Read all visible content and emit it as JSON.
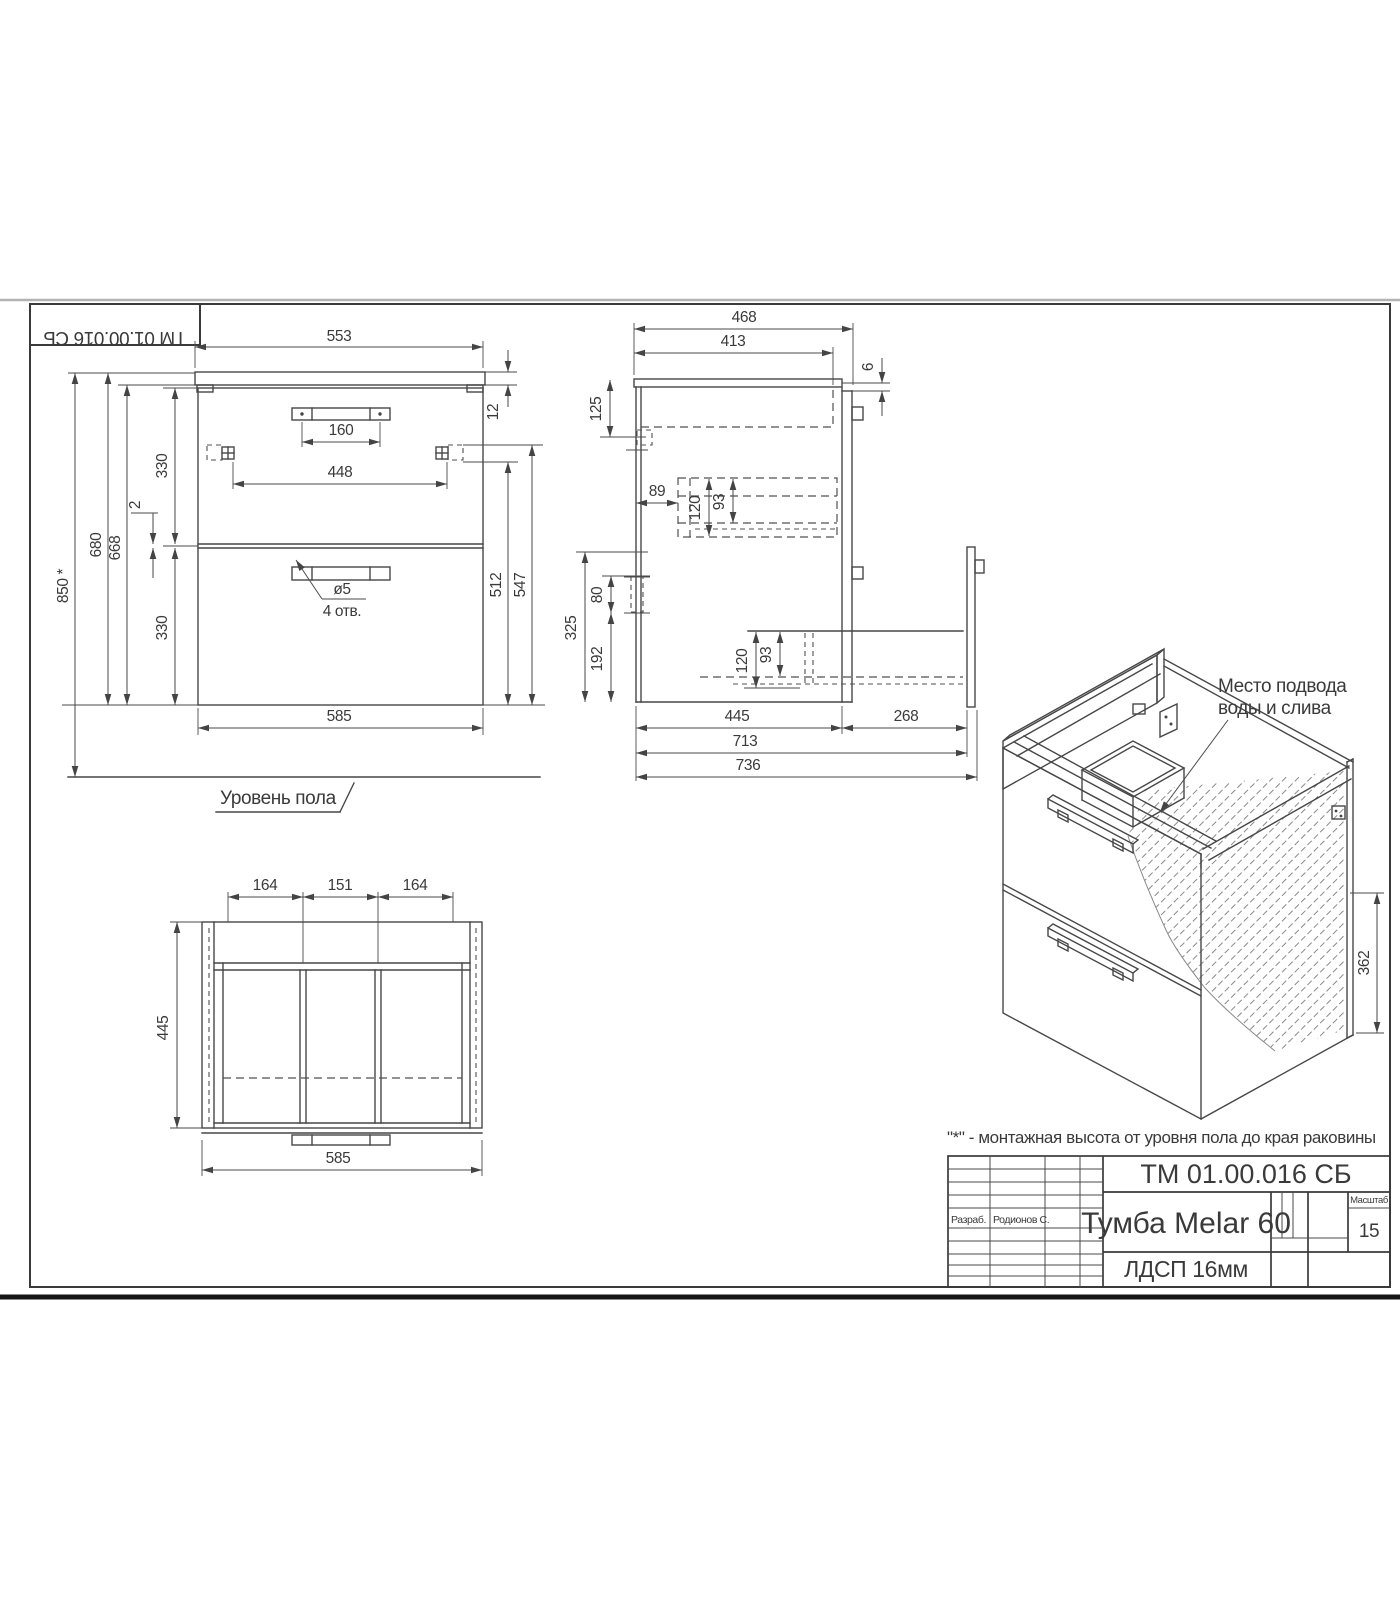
{
  "corner_stamp": {
    "text": "ТМ 01.00.016 СБ"
  },
  "front_view": {
    "floor_label": "Уровень пола",
    "hole_dia": "ø5",
    "hole_qty": "4 отв.",
    "dims": {
      "w553": "553",
      "w160": "160",
      "w448": "448",
      "t12": "12",
      "h330_top": "330",
      "gap2": "2",
      "h680": "680",
      "h668": "668",
      "h850": "850 *",
      "h330_bottom": "330",
      "h512": "512",
      "h547": "547",
      "w585": "585"
    }
  },
  "side_view": {
    "dims": {
      "d468": "468",
      "d413": "413",
      "g6": "6",
      "h125": "125",
      "d89": "89",
      "h120_top": "120",
      "h93_top": "93",
      "h80": "80",
      "h325": "325",
      "h192": "192",
      "h120_bottom": "120",
      "h93_bottom": "93",
      "d445": "445",
      "d268": "268",
      "d713": "713",
      "d736": "736"
    }
  },
  "top_view": {
    "dims": {
      "w164_left": "164",
      "w151": "151",
      "w164_right": "164",
      "d445": "445",
      "w585": "585"
    }
  },
  "iso_view": {
    "callout_line1": "Место подвода",
    "callout_line2": "воды и слива",
    "dim_362": "362"
  },
  "note": {
    "text": "\"*\" - монтажная высота от уровня пола до края раковины"
  },
  "title_block": {
    "doc_number": "ТМ 01.00.016 СБ",
    "product_name": "Тумба Melar 60",
    "material": "ЛДСП 16мм",
    "scale_label": "Масштаб",
    "scale_value": "15",
    "developed_by_label": "Разраб.",
    "developed_by_name": "Родионов С."
  }
}
